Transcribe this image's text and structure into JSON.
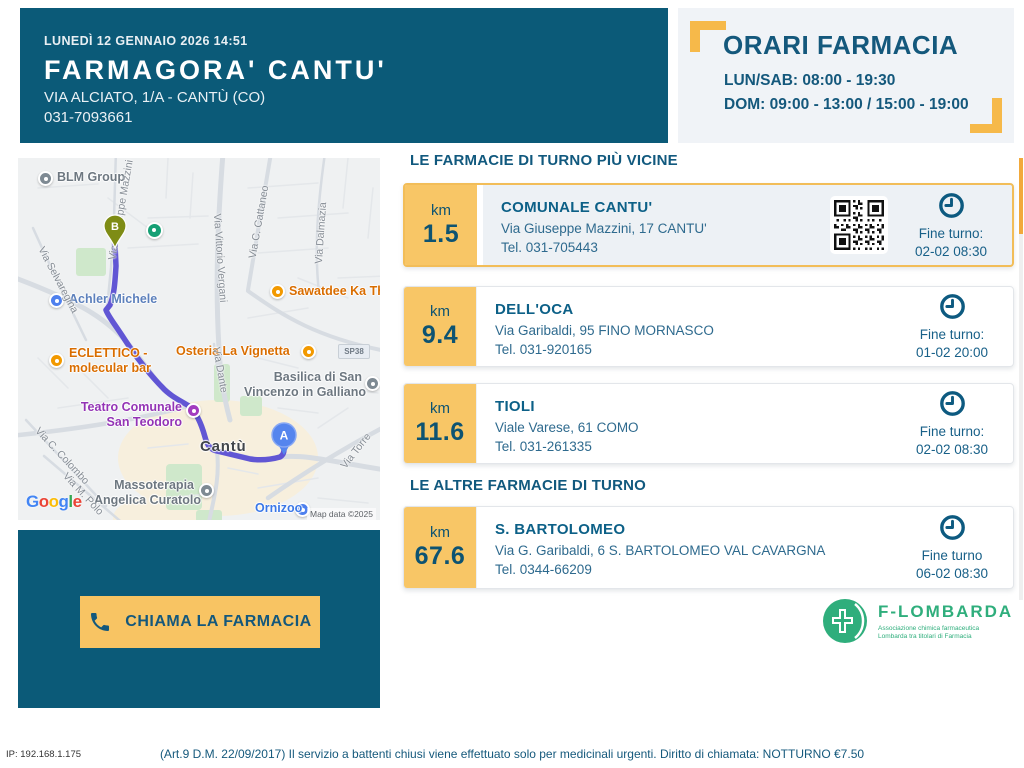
{
  "header": {
    "datetime": "LUNEDÌ 12 GENNAIO 2026 14:51",
    "title": "FARMAGORA' CANTU'",
    "address": "VIA ALCIATO, 1/A - CANTÙ (CO)",
    "phone": "031-7093661"
  },
  "orari": {
    "title": "ORARI FARMACIA",
    "line1": "LUN/SAB: 08:00 - 19:30",
    "line2": "DOM: 09:00 - 13:00 / 15:00 - 19:00"
  },
  "map": {
    "city": "Cantù",
    "markers": {
      "a": "A",
      "b": "B"
    },
    "road_badge": "SP38",
    "google_letters": [
      "G",
      "o",
      "o",
      "g",
      "l",
      "e"
    ],
    "attribution": "Map data ©2025",
    "streets": [
      "Via Giuseppe Mazzini",
      "Via Selvaregina",
      "Via Vittorio Vergani",
      "Via C. Cattaneo",
      "Via Dalmazia",
      "Via Dante",
      "Via C. Colombo",
      "Via M. Polo",
      "Via Torre"
    ],
    "pois": [
      {
        "label": "BLM Group"
      },
      {
        "label": "Achler Michele"
      },
      {
        "label": "Sawatdee Ka Thai Fo"
      },
      {
        "line1": "ECLETTICO -",
        "line2": "molecular bar"
      },
      {
        "label": "Osteria La Vignetta"
      },
      {
        "line1": "Basilica di San",
        "line2": "Vincenzo in Galliano"
      },
      {
        "line1": "Teatro Comunale",
        "line2": "San Teodoro"
      },
      {
        "line1": "Massoterapia",
        "line2": "Angelica Curatolo"
      },
      {
        "label": "Ornizoo"
      }
    ]
  },
  "call_button": {
    "label": "CHIAMA LA FARMACIA"
  },
  "sections": {
    "nearest": "LE FARMACIE DI TURNO PIÙ VICINE",
    "others": "LE ALTRE FARMACIE DI TURNO"
  },
  "pharmacies": [
    {
      "km_unit": "km",
      "km": "1.5",
      "name": "COMUNALE CANTU'",
      "address": "Via Giuseppe Mazzini, 17 CANTU'",
      "tel": "Tel. 031-705443",
      "fine_label": "Fine turno:",
      "fine_value": "02-02 08:30"
    },
    {
      "km_unit": "km",
      "km": "9.4",
      "name": "DELL'OCA",
      "address": "Via Garibaldi, 95 FINO MORNASCO",
      "tel": "Tel. 031-920165",
      "fine_label": "Fine turno:",
      "fine_value": "01-02 20:00"
    },
    {
      "km_unit": "km",
      "km": "11.6",
      "name": "TIOLI",
      "address": "Viale Varese, 61 COMO",
      "tel": "Tel. 031-261335",
      "fine_label": "Fine turno:",
      "fine_value": "02-02 08:30"
    },
    {
      "km_unit": "km",
      "km": "67.6",
      "name": "S. BARTOLOMEO",
      "address": "Via G. Garibaldi, 6 S. BARTOLOMEO VAL CAVARGNA",
      "tel": "Tel. 0344-66209",
      "fine_label": "Fine turno",
      "fine_value": "06-02 08:30"
    }
  ],
  "logo": {
    "name": "F-LOMBARDA",
    "tagline1": "Associazione chimica farmaceutica",
    "tagline2": "Lombarda tra titolari di Farmacia"
  },
  "footer": {
    "ip": "IP: 192.168.1.175",
    "legal": "(Art.9 D.M. 22/09/2017) Il servizio a battenti chiusi viene effettuato solo per medicinali urgenti. Diritto di chiamata: NOTTURNO €7.50"
  },
  "colors": {
    "teal": "#0b5a78",
    "accent_orange": "#f8c463",
    "bracket_orange": "#f6b94a",
    "route_purple": "#6156d4",
    "logo_green": "#2fae7c"
  }
}
